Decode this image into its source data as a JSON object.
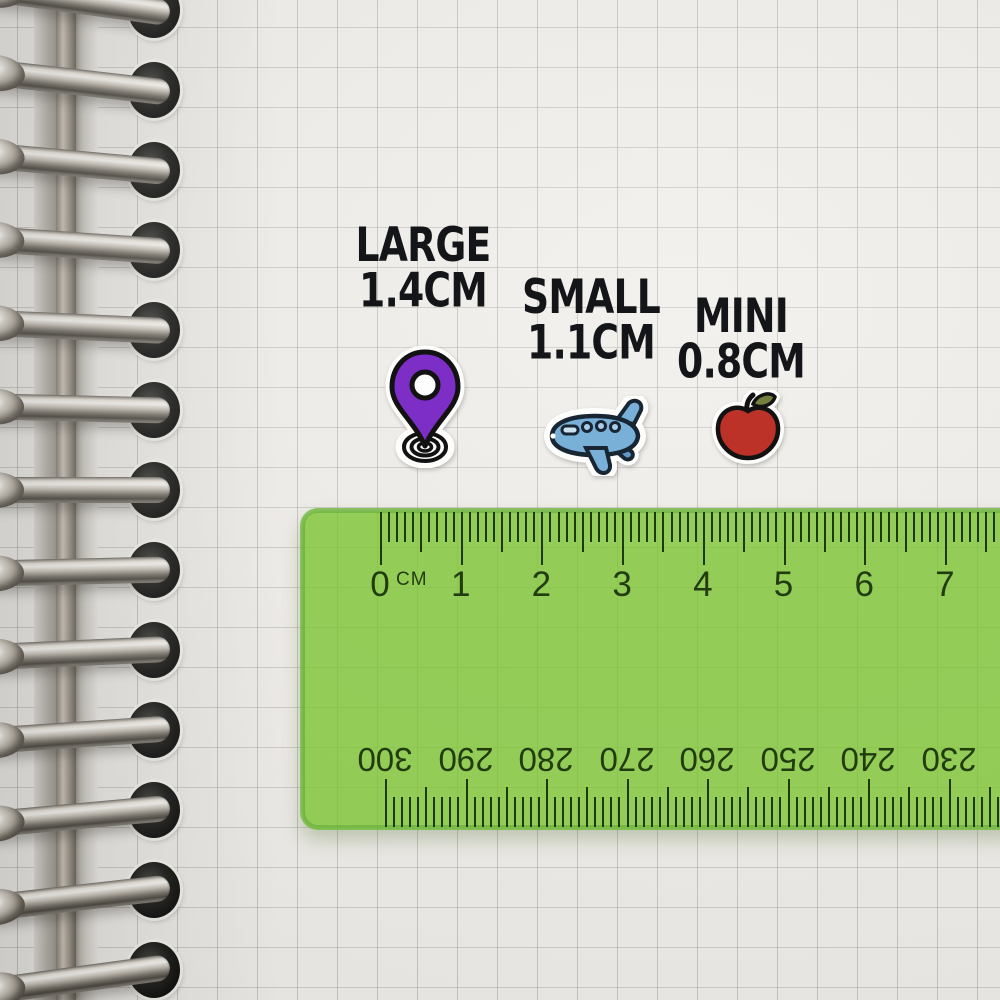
{
  "labels": [
    {
      "id": "large",
      "title": "LARGE",
      "size": "1.4CM"
    },
    {
      "id": "small",
      "title": "SMALL",
      "size": "1.1CM"
    },
    {
      "id": "mini",
      "title": "MINI",
      "size": "0.8CM"
    }
  ],
  "stickers": [
    {
      "name": "location-pin",
      "color": "#7d2ec6"
    },
    {
      "name": "airplane",
      "color": "#79b0d8"
    },
    {
      "name": "apple",
      "color": "#bd3228"
    }
  ],
  "ruler": {
    "unit": "CM",
    "cm_numbers": [
      "0",
      "1",
      "2",
      "3",
      "4",
      "5",
      "6",
      "7"
    ],
    "mm_numbers": [
      "300",
      "290",
      "280",
      "270",
      "260",
      "250",
      "240",
      "230"
    ],
    "body_color": "#7dc637",
    "tick_color": "#1d3a0f"
  },
  "colors": {
    "paper": "#f0eeea",
    "grid_line": "#8c8880",
    "label_text": "#141518"
  }
}
